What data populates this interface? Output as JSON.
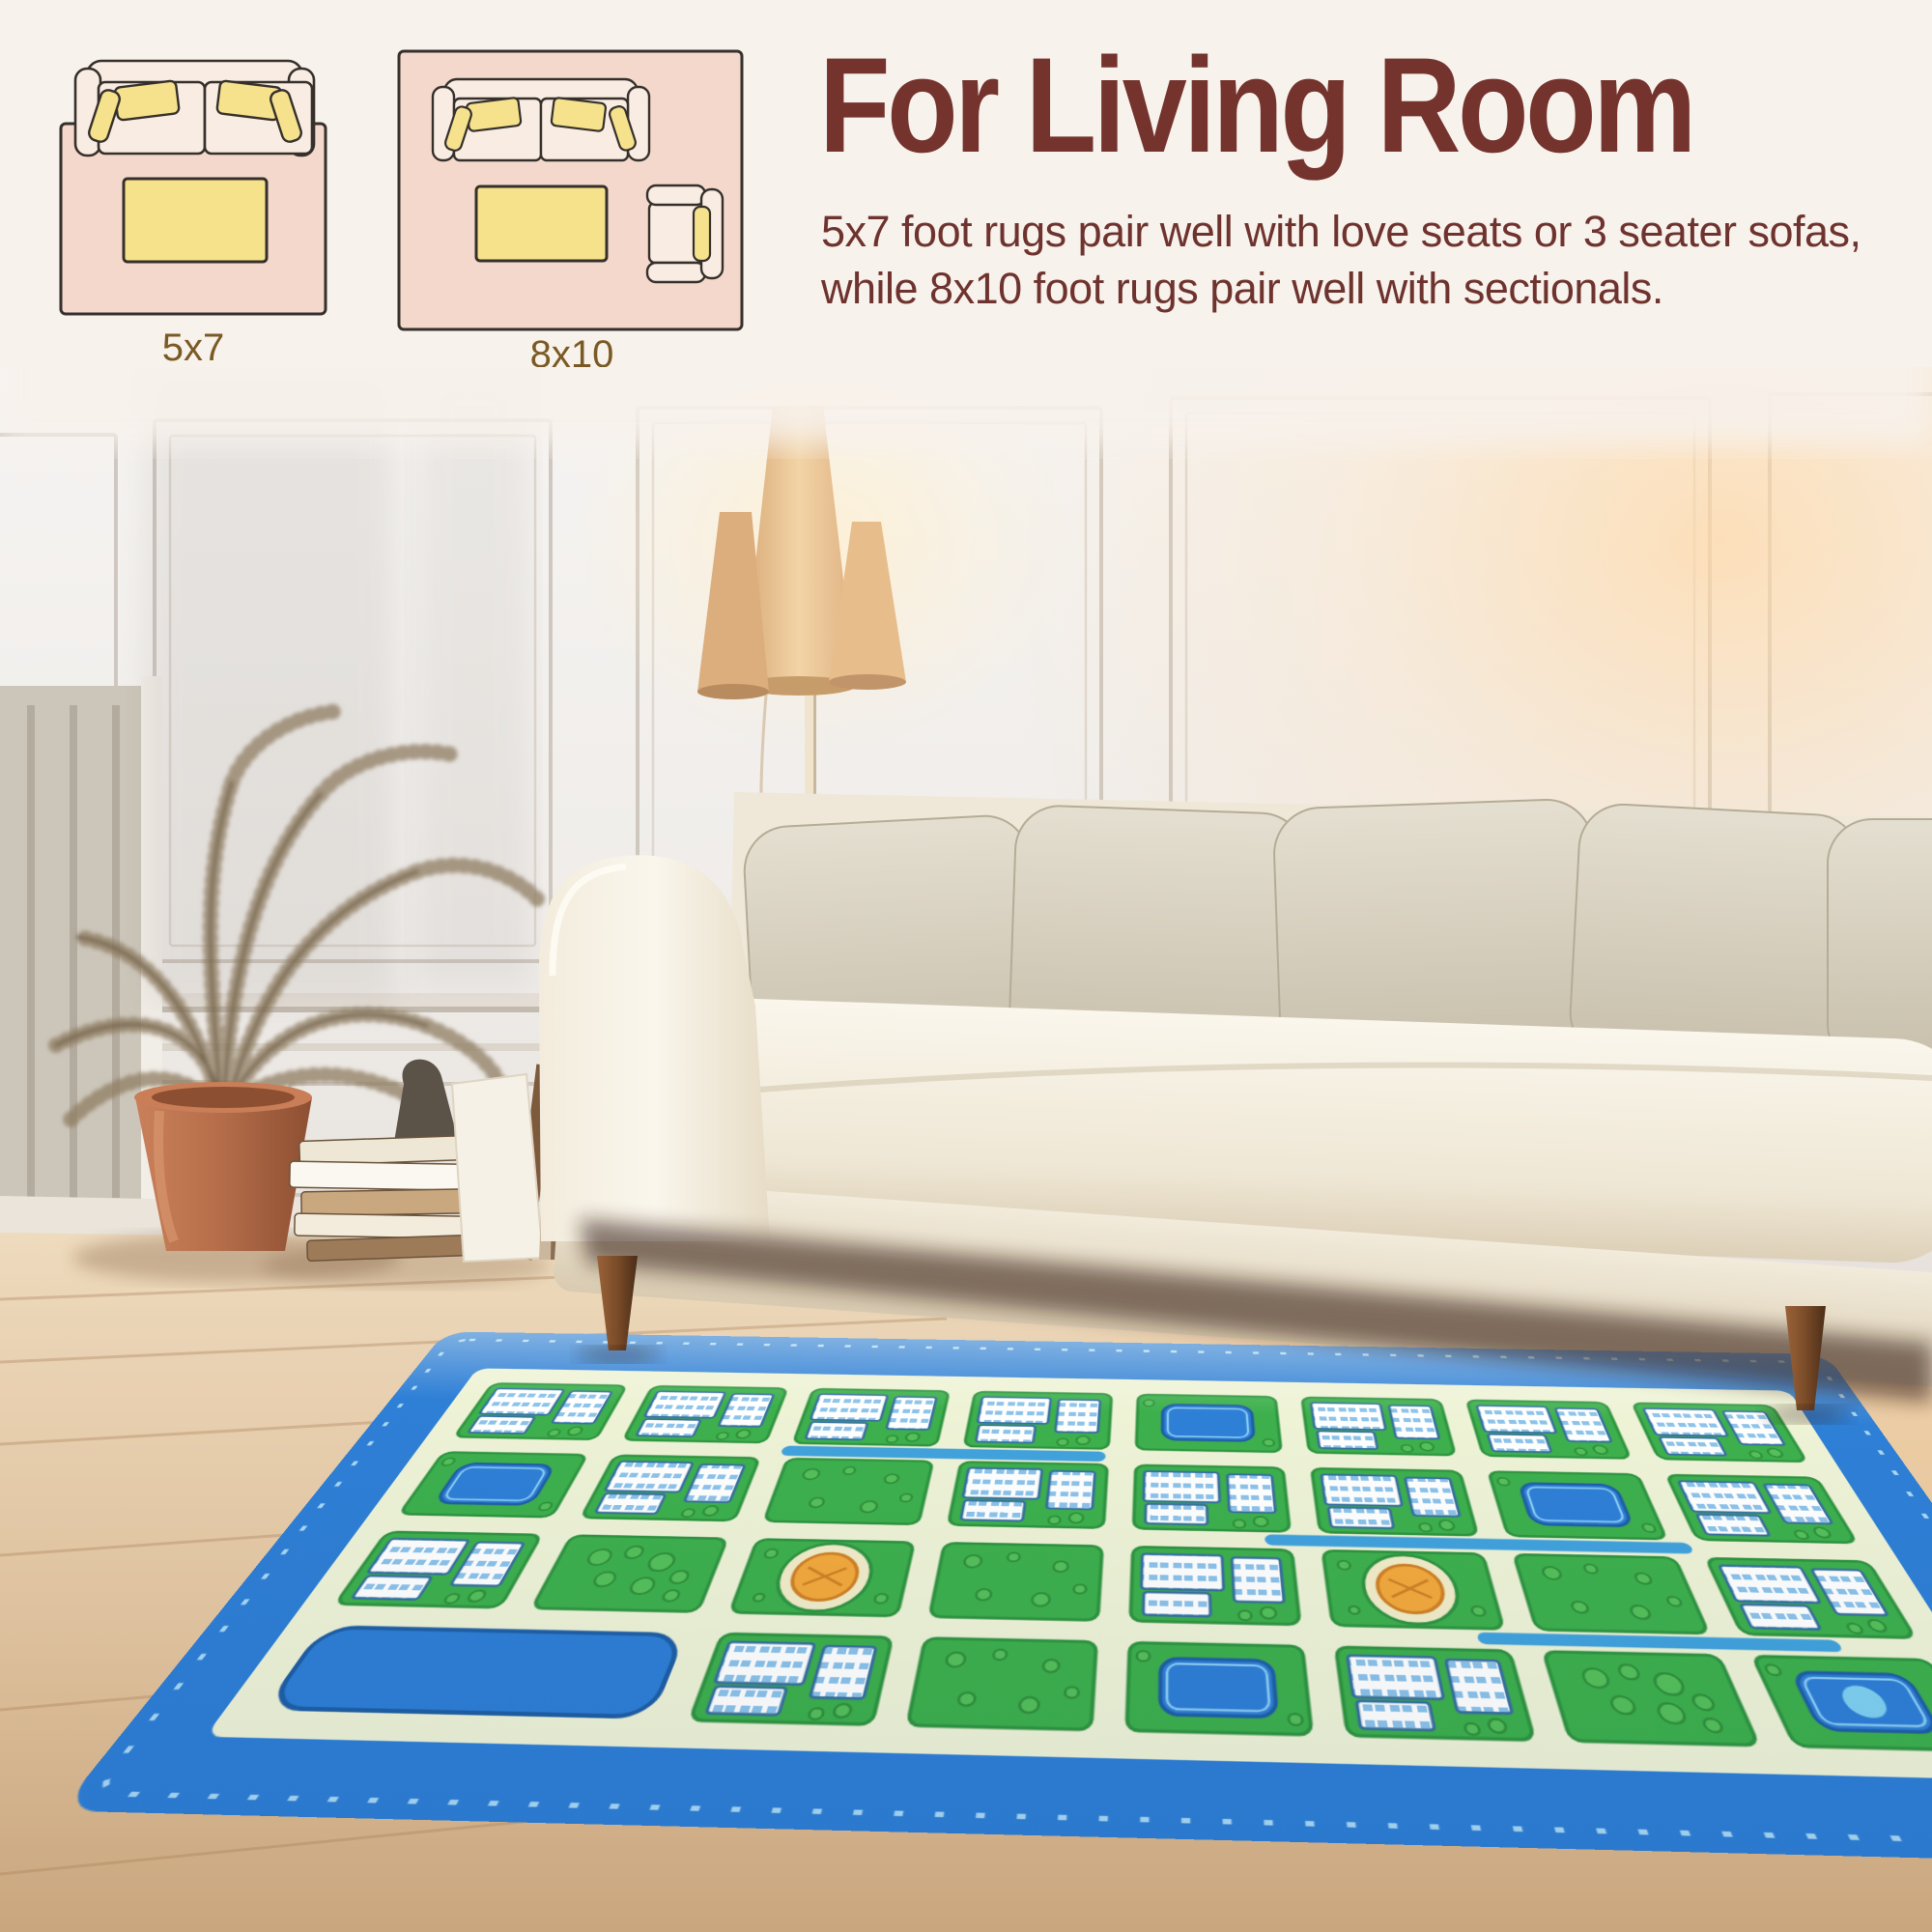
{
  "header": {
    "title": "For Living Room",
    "description": "5x7 foot rugs pair well with love seats or 3 seater sofas, while 8x10 foot rugs pair well with sectionals."
  },
  "diagrams": {
    "small_label": "5x7",
    "large_label": "8x10"
  },
  "colors": {
    "band_background": "#f8f2ec",
    "heading_text": "#74332d",
    "body_text": "#6e332e",
    "size_label_text": "#7a5a24",
    "diagram_rug_pink": "#f3d8cb",
    "diagram_sofa_fill": "#f9ece3",
    "diagram_pillow_yellow": "#f6e18c",
    "diagram_outline": "#35302b",
    "wall_white": "#f3f0ed",
    "sofa_cream": "#f5efe2",
    "pillow_grey": "#d9d2c3",
    "floor_wood": "#e2cbab",
    "pot_terracotta": "#b76f4b",
    "lamp_shade_tan": "#e9c292",
    "rug_border_blue": "#2e7fd6",
    "rug_field_cream": "#eef3d6",
    "rug_block_green": "#3db04d",
    "rug_pool_blue": "#2e7fd6",
    "rug_roundabout_orange": "#f3a93c"
  },
  "rug_map": {
    "cols": 8,
    "rows": 4,
    "border": "#2e7fd6",
    "dash": "#a9d9f5",
    "field": "#eef3d6",
    "block": "#3db04d",
    "block_stroke": "#2f9440",
    "pool": "#2e7fd6",
    "pool_stroke": "#1f5fa6",
    "pool_inner": "#8fd0f4",
    "orange": "#f3a93c",
    "orange_stroke": "#cf8124",
    "tree": "#55c05a",
    "tree_stroke": "#2f8f3a",
    "building_stroke": "#36709f",
    "water": "#41a2dc",
    "blocks": [
      [
        "B",
        "B",
        "B",
        "B",
        "P",
        "B",
        "B",
        "B"
      ],
      [
        "P",
        "B",
        "G",
        "B",
        "B",
        "B",
        "P",
        "B"
      ],
      [
        "B",
        "T",
        "K",
        "G",
        "B",
        "K",
        "G",
        "B"
      ],
      [
        "X",
        "X",
        "B",
        "G",
        "P",
        "B",
        "T",
        "P"
      ]
    ]
  }
}
